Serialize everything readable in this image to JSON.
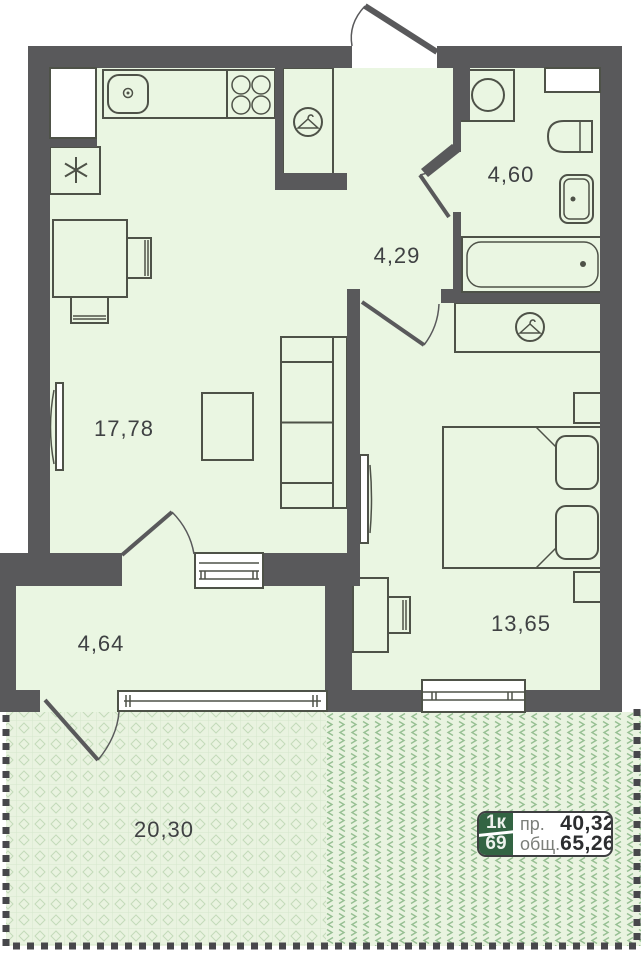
{
  "rooms": {
    "living": "17,78",
    "hallway": "4,29",
    "bathroom": "4,60",
    "bedroom": "13,65",
    "loggia": "4,64",
    "terrace": "20,30"
  },
  "badge": {
    "unit_type": "1к",
    "unit_number": "69",
    "living_area_label": "пр.",
    "living_area_value": "40,32",
    "total_area_label": "общ.",
    "total_area_value": "65,26"
  },
  "icons": {
    "wardrobe": "hanger-icon",
    "fridge": "snowflake-icon",
    "washing_machine": "drum-circle-icon"
  },
  "colors": {
    "wall": "#59595b",
    "room_fill": "#eaf6e2",
    "line": "#4e5248",
    "dash": "#47474b",
    "terrace_bg": "#e9f3e0",
    "lat_grid": "#d5e7cd",
    "lat_diamond": "#c3dbb9",
    "chev": "#96bf92",
    "badge_green": "#336443",
    "badge_border": "#3e3f41",
    "badge_label": "#7c7f7a",
    "badge_value": "#2c2d2f",
    "label_text": "#3f4143"
  }
}
